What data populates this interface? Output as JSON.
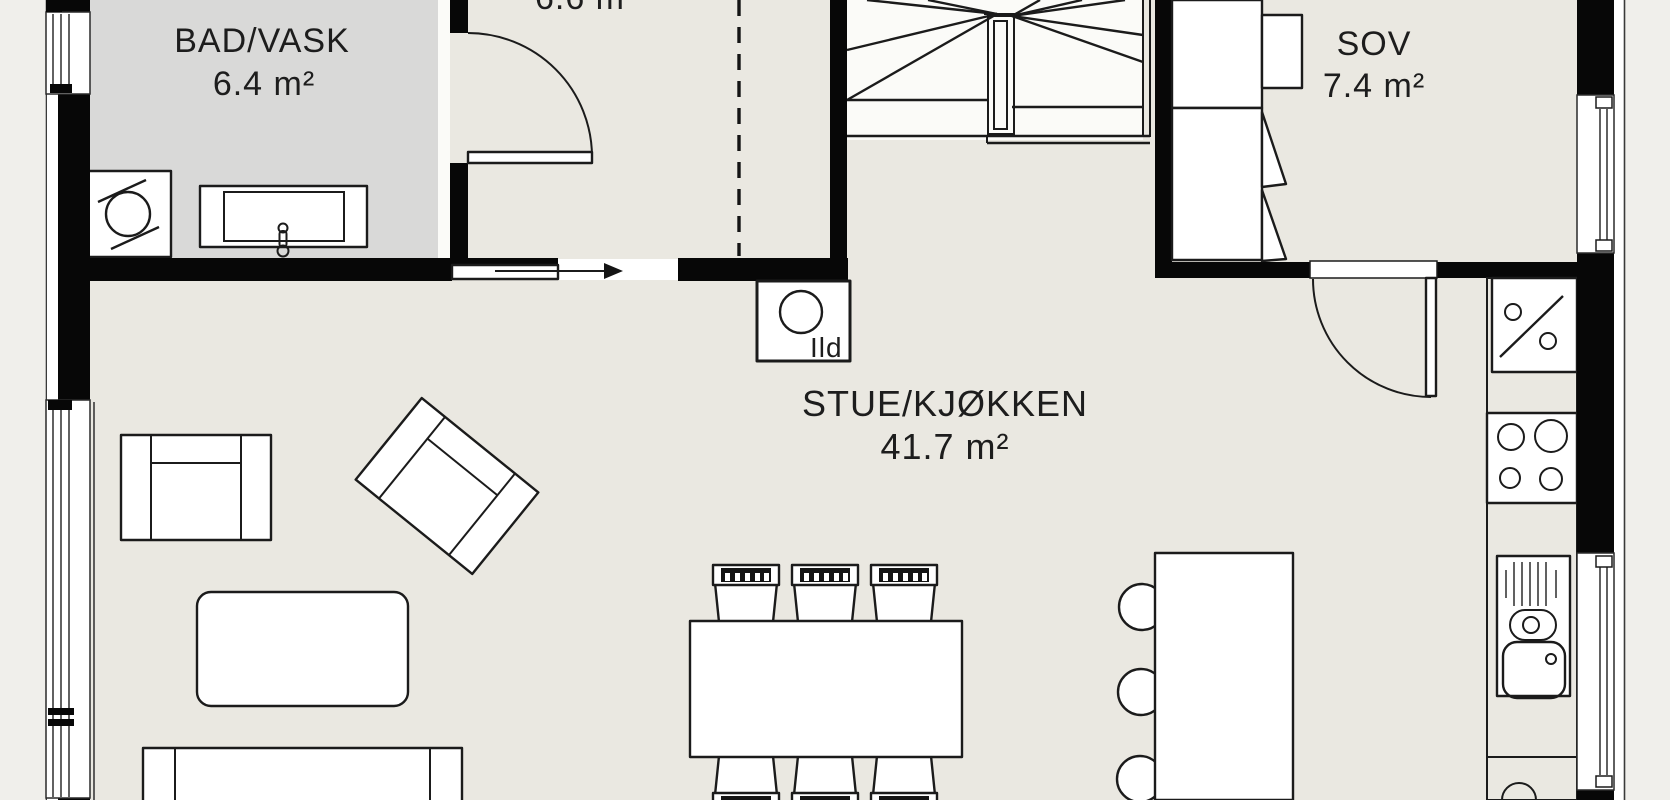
{
  "rooms": {
    "bad": {
      "name": "BAD/VASK",
      "area": "6.4 m²"
    },
    "hall": {
      "area_partial": "6.6 m"
    },
    "sov": {
      "name": "SOV",
      "area": "7.4 m²"
    },
    "stue": {
      "name": "STUE/KJØKKEN",
      "area": "41.7 m²"
    }
  },
  "fixtures": {
    "fireplace_label": "Ild"
  },
  "colors": {
    "outside": "#f0efeb",
    "floor": "#eae8e1",
    "bad_floor": "#d9d9d8",
    "wall": "#070707",
    "stroke": "#1b1b1b"
  }
}
